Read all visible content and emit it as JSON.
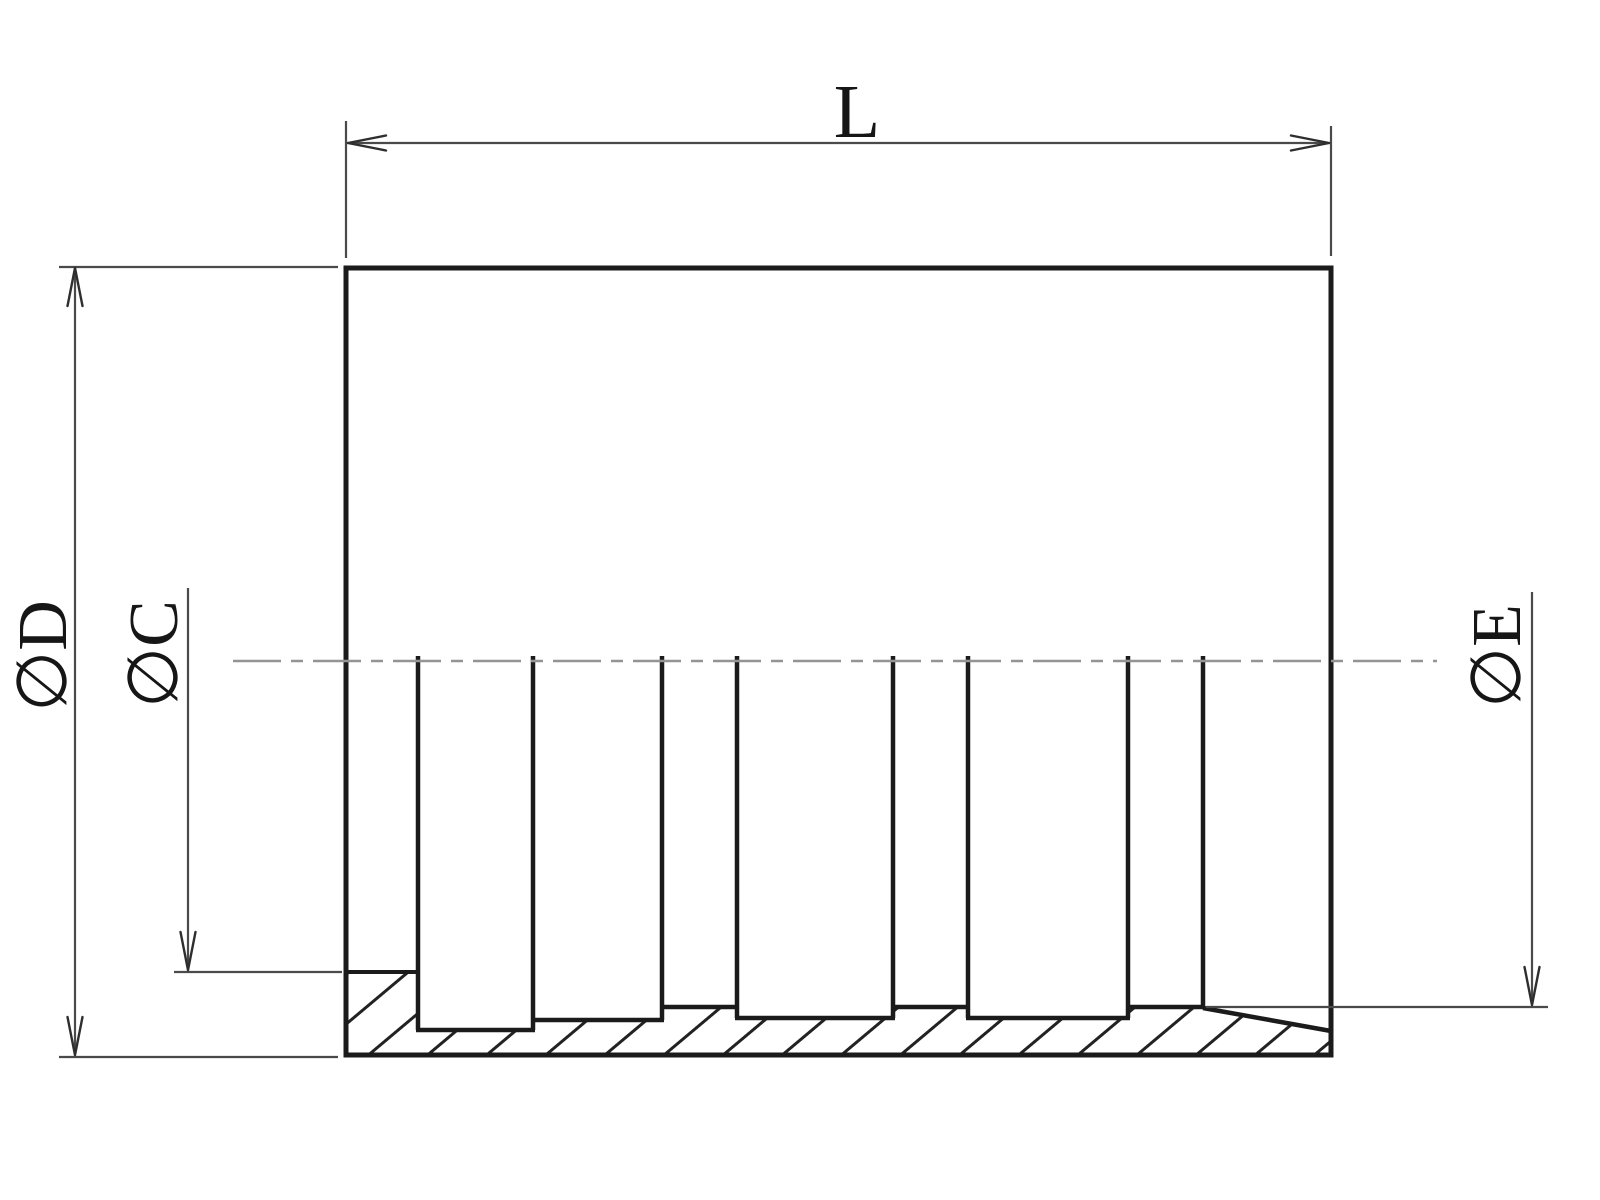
{
  "drawing": {
    "labels": {
      "length": "L",
      "outer_diameter": "∅D",
      "bore_diameter": "∅C",
      "inner_diameter": "∅E"
    },
    "colors": {
      "background": "#ffffff",
      "object_line": "#1b1b1b",
      "dimension_line": "#4a4a4a",
      "centerline": "#949494",
      "hatch_line": "#222222"
    }
  }
}
